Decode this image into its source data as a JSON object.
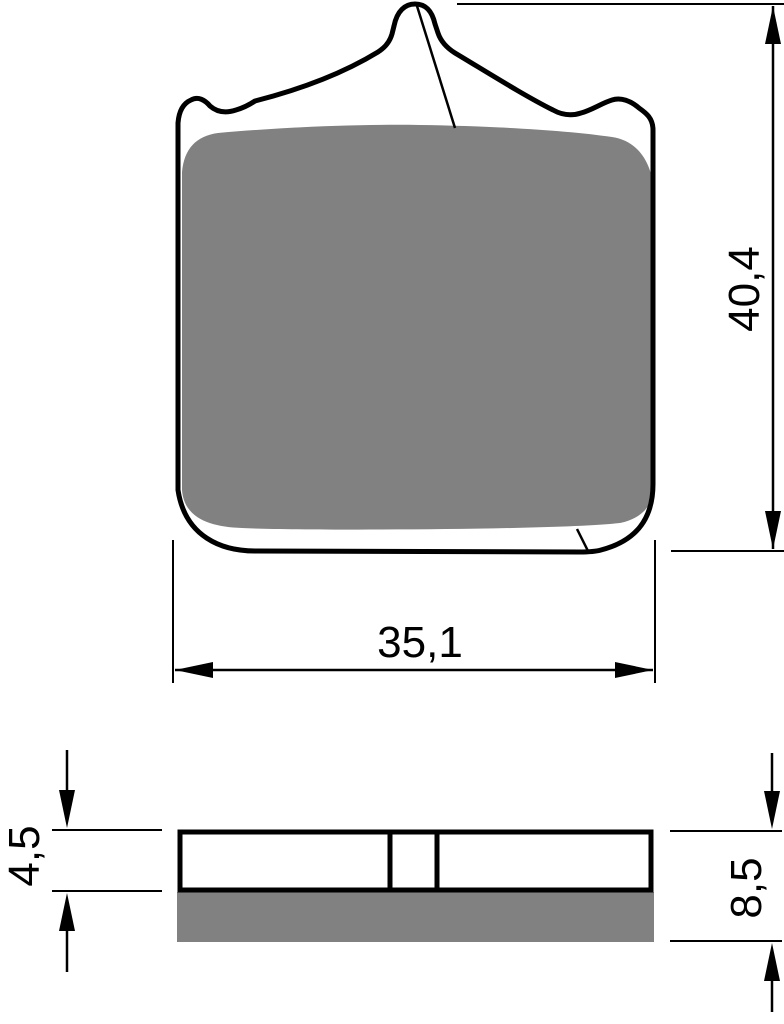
{
  "drawing": {
    "title": "brake-pad-technical-drawing",
    "views": {
      "front": {
        "dimensions": {
          "height": {
            "label": "40,4"
          },
          "width": {
            "label": "35,1"
          }
        }
      },
      "side": {
        "dimensions": {
          "plate_thickness": {
            "label": "4,5"
          },
          "total_thickness": {
            "label": "8,5"
          }
        }
      }
    },
    "colors": {
      "line": "#000000",
      "friction_material": "#818181",
      "background": "#ffffff"
    }
  }
}
